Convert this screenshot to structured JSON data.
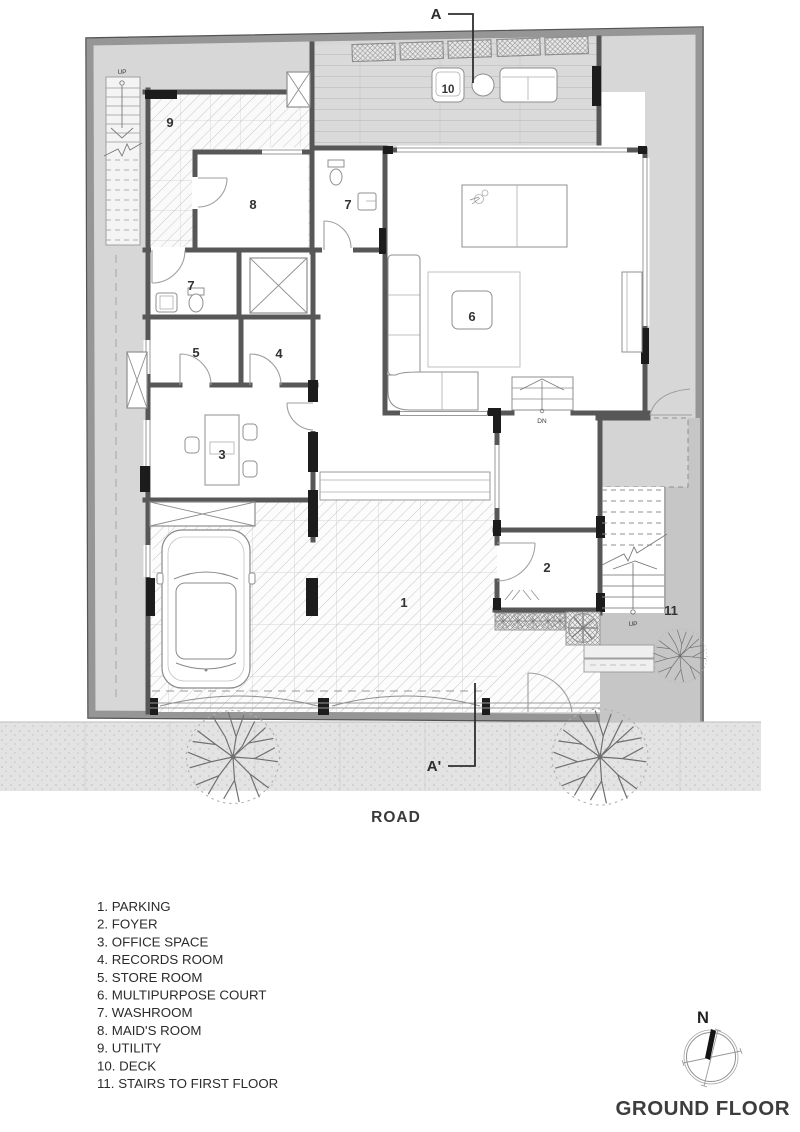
{
  "plan": {
    "title": "GROUND FLOOR",
    "road_label": "ROAD",
    "north_label": "N",
    "section_top": "A",
    "section_bottom": "A'",
    "up_label": "UP",
    "down_label": "DN"
  },
  "rooms": [
    {
      "num": "1",
      "name": "PARKING",
      "legend_text": "1. PARKING"
    },
    {
      "num": "2",
      "name": "FOYER",
      "legend_text": "2. FOYER"
    },
    {
      "num": "3",
      "name": "OFFICE SPACE",
      "legend_text": "3. OFFICE SPACE"
    },
    {
      "num": "4",
      "name": "RECORDS ROOM",
      "legend_text": "4. RECORDS ROOM"
    },
    {
      "num": "5",
      "name": "STORE ROOM",
      "legend_text": "5. STORE ROOM"
    },
    {
      "num": "6",
      "name": "MULTIPURPOSE COURT",
      "legend_text": "6. MULTIPURPOSE COURT"
    },
    {
      "num": "7",
      "name": "WASHROOM",
      "legend_text": "7. WASHROOM"
    },
    {
      "num": "8",
      "name": "MAID'S ROOM",
      "legend_text": "8. MAID'S ROOM"
    },
    {
      "num": "9",
      "name": "UTILITY",
      "legend_text": "9. UTILITY"
    },
    {
      "num": "10",
      "name": "DECK",
      "legend_text": "10. DECK"
    },
    {
      "num": "11",
      "name": "STAIRS TO FIRST FLOOR",
      "legend_text": "11. STAIRS TO FIRST FLOOR"
    }
  ],
  "colors": {
    "wall": "#575757",
    "site_gray": "#d7d7d7",
    "accent_black": "#1c1c1c",
    "road_gray": "#e3e3e3",
    "text": "#2b2b2b"
  }
}
